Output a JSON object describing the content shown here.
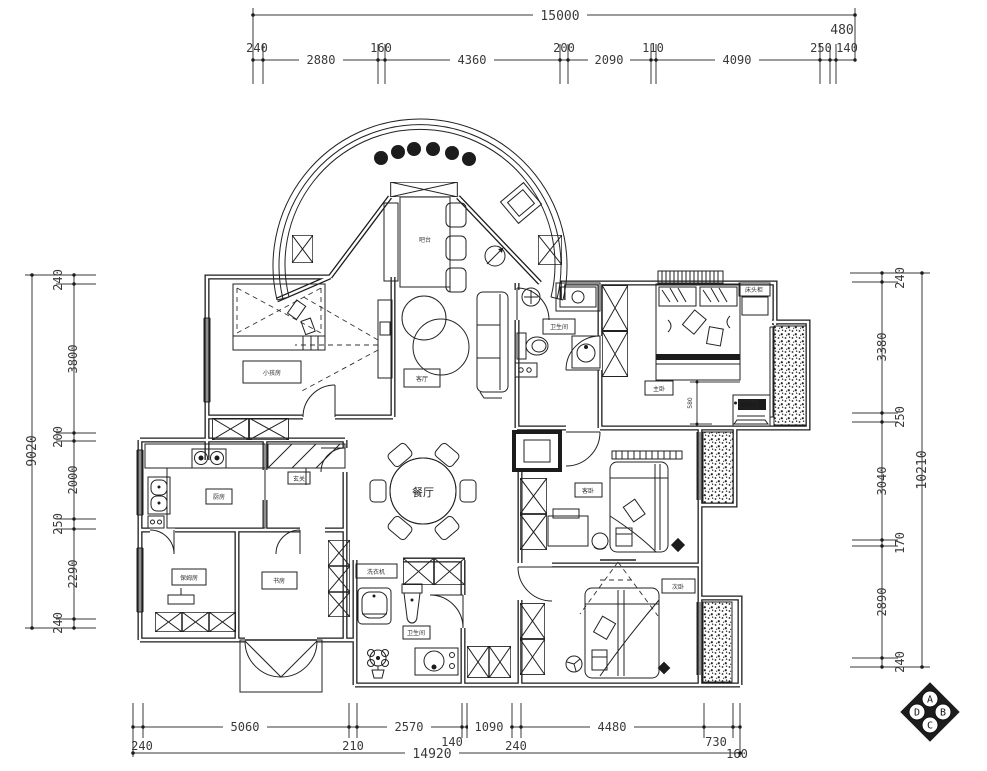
{
  "page": {
    "background": "#ffffff",
    "kind": "apartment-floor-plan"
  },
  "colors": {
    "line": "#1c1c1c",
    "dim_text": "#3a3a3a",
    "paper": "#ffffff"
  },
  "dims": {
    "top_overall": "15000",
    "top_overhang": "480",
    "top_segments": [
      "240",
      "2880",
      "160",
      "4360",
      "200",
      "2090",
      "110",
      "4090",
      "250",
      "140"
    ],
    "left_overall": "9020",
    "left_segments": [
      "240",
      "3800",
      "200",
      "2000",
      "250",
      "2290",
      "240"
    ],
    "right_overall": "10210",
    "right_segments": [
      "240",
      "3380",
      "250",
      "3040",
      "170",
      "2890",
      "240"
    ],
    "bottom_overall": "14920",
    "bottom_segments": [
      "240",
      "5060",
      "210",
      "2570",
      "140",
      "1090",
      "240",
      "4480",
      "730",
      "160"
    ],
    "bed_offset": "580"
  },
  "labels": {
    "dining": "餐厅",
    "living": "客厅",
    "bar": "吧台",
    "bedroom_left": "小孩房",
    "kitchen": "厨房",
    "hallway": "玄关",
    "maid_room": "保姆房",
    "study": "书房",
    "bath_main": "卫生间",
    "laundry": "洗衣机",
    "bath_master": "卫生间",
    "master": "主卧",
    "nightstand": "床头柜",
    "bedroom_mid": "客卧",
    "bedroom_bottom": "次卧"
  },
  "compass": {
    "a": "A",
    "b": "B",
    "c": "C",
    "d": "D"
  }
}
